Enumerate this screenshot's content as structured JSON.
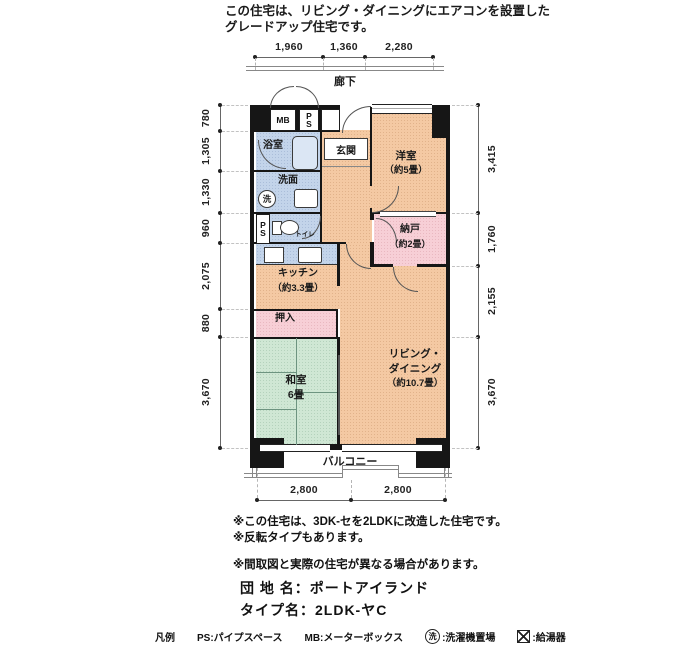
{
  "header": {
    "line1": "この住宅は、リビング・ダイニングにエアコンを設置した",
    "line2": "グレードアップ住宅です。"
  },
  "dims": {
    "top": [
      "1,960",
      "1,360",
      "2,280"
    ],
    "bottom": [
      "2,800",
      "2,800"
    ],
    "left": [
      "780",
      "1,305",
      "1,330",
      "960",
      "2,075",
      "880",
      "3,670"
    ],
    "right": [
      "3,415",
      "1,760",
      "2,155",
      "3,670"
    ]
  },
  "plan": {
    "corridor": "廊下",
    "balcony": "バルコニー",
    "mb": "MB",
    "ps": "PS",
    "bath": "浴室",
    "washroom": "洗面",
    "wash_symbol": "洗",
    "toilet": "トイレ",
    "entrance": "玄関",
    "western": {
      "name": "洋室",
      "size": "（約5畳）"
    },
    "storage": {
      "name": "納戸",
      "size": "（約2畳）"
    },
    "kitchen": {
      "name": "キッチン",
      "size": "（約3.3畳）"
    },
    "closet": "押入",
    "japanese": {
      "name": "和室",
      "size": "6畳"
    },
    "living": {
      "l1": "リビング・",
      "l2": "ダイニング",
      "l3": "（約10.7畳）"
    }
  },
  "notes": {
    "n1": "※この住宅は、3DK-セを2LDKに改造した住宅です。",
    "n2": "※反転タイプもあります。",
    "n3": "※間取図と実際の住宅が異なる場合があります。"
  },
  "building": {
    "name": "団 地 名：ポートアイランド",
    "type": "タイプ名：2LDK-ヤC"
  },
  "legend": {
    "title": "凡例",
    "ps": "PS:パイプスペース",
    "mb": "MB:メーターボックス",
    "wash_symbol": "洗",
    "wash_label": ":洗濯機置場",
    "heater_label": ":給湯器"
  },
  "colors": {
    "room_peach": "#f4c9a3",
    "room_green": "#cfe7d4",
    "room_blue": "#c3d4ea",
    "room_pink": "#f7cfd6",
    "wall": "#161616"
  }
}
